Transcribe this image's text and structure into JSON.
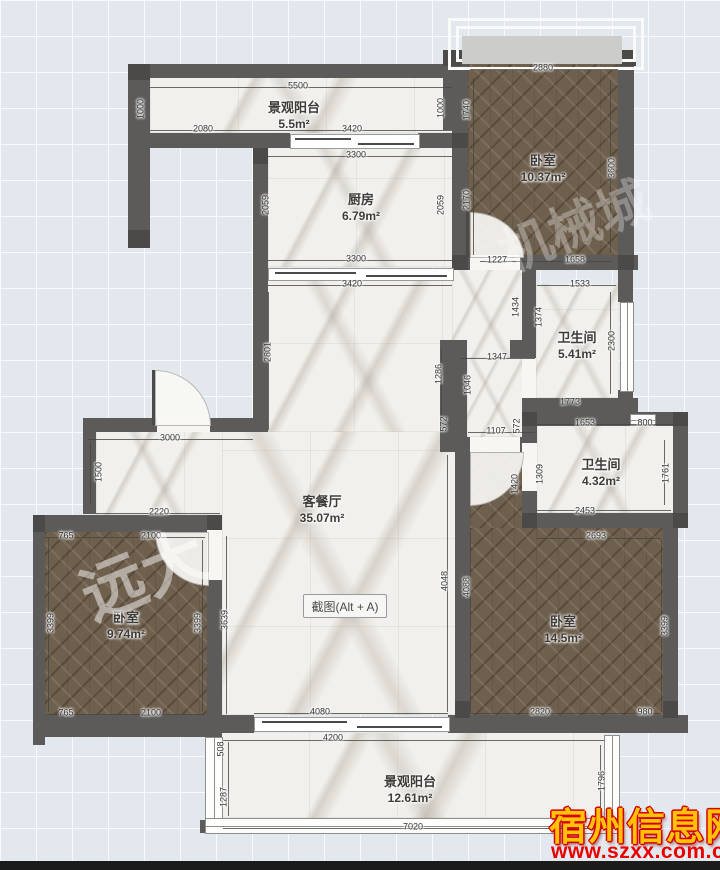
{
  "plan": {
    "type": "apartment-floor-plan",
    "total_labeled_area_m2": 104.35
  },
  "rooms": [
    {
      "name": "景观阳台",
      "area": "5.5m²"
    },
    {
      "name": "厨房",
      "area": "6.79m²"
    },
    {
      "name": "卧室",
      "area": "10.37m²"
    },
    {
      "name": "卫生间",
      "area": "5.41m²"
    },
    {
      "name": "卫生间",
      "area": "4.32m²"
    },
    {
      "name": "客餐厅",
      "area": "35.07m²"
    },
    {
      "name": "卧室",
      "area": "9.74m²"
    },
    {
      "name": "卧室",
      "area": "14.5m²"
    },
    {
      "name": "景观阳台",
      "area": "12.61m²"
    }
  ],
  "dimensions": [
    {
      "t": "5500",
      "x": 298,
      "y": 86,
      "v": 0
    },
    {
      "t": "1000",
      "x": 141,
      "y": 109,
      "v": 1
    },
    {
      "t": "2080",
      "x": 203,
      "y": 129,
      "v": 0
    },
    {
      "t": "3420",
      "x": 352,
      "y": 129,
      "v": 0
    },
    {
      "t": "1000",
      "x": 441,
      "y": 108,
      "v": 1
    },
    {
      "t": "1740",
      "x": 467,
      "y": 110,
      "v": 1
    },
    {
      "t": "2880",
      "x": 543,
      "y": 68,
      "v": 0
    },
    {
      "t": "3300",
      "x": 356,
      "y": 155,
      "v": 0
    },
    {
      "t": "2059",
      "x": 266,
      "y": 205,
      "v": 1
    },
    {
      "t": "2059",
      "x": 441,
      "y": 205,
      "v": 1
    },
    {
      "t": "2170",
      "x": 467,
      "y": 200,
      "v": 1
    },
    {
      "t": "3600",
      "x": 612,
      "y": 168,
      "v": 1
    },
    {
      "t": "3300",
      "x": 356,
      "y": 259,
      "v": 0
    },
    {
      "t": "1227",
      "x": 497,
      "y": 260,
      "v": 0
    },
    {
      "t": "1658",
      "x": 575,
      "y": 260,
      "v": 0
    },
    {
      "t": "3420",
      "x": 352,
      "y": 284,
      "v": 0
    },
    {
      "t": "2801",
      "x": 268,
      "y": 352,
      "v": 1
    },
    {
      "t": "1533",
      "x": 580,
      "y": 284,
      "v": 0
    },
    {
      "t": "1434",
      "x": 516,
      "y": 307,
      "v": 1
    },
    {
      "t": "1374",
      "x": 539,
      "y": 317,
      "v": 1
    },
    {
      "t": "2300",
      "x": 612,
      "y": 341,
      "v": 1
    },
    {
      "t": "1347",
      "x": 497,
      "y": 357,
      "v": 0
    },
    {
      "t": "1046",
      "x": 468,
      "y": 385,
      "v": 1
    },
    {
      "t": "1286",
      "x": 439,
      "y": 374,
      "v": 1
    },
    {
      "t": "572",
      "x": 444,
      "y": 424,
      "v": 1
    },
    {
      "t": "572",
      "x": 517,
      "y": 426,
      "v": 1
    },
    {
      "t": "1107",
      "x": 496,
      "y": 431,
      "v": 0
    },
    {
      "t": "1773",
      "x": 570,
      "y": 402,
      "v": 0
    },
    {
      "t": "1653",
      "x": 585,
      "y": 423,
      "v": 0
    },
    {
      "t": "800",
      "x": 645,
      "y": 423,
      "v": 0
    },
    {
      "t": "1420",
      "x": 515,
      "y": 484,
      "v": 1
    },
    {
      "t": "1309",
      "x": 540,
      "y": 474,
      "v": 1
    },
    {
      "t": "1761",
      "x": 666,
      "y": 473,
      "v": 1
    },
    {
      "t": "2453",
      "x": 585,
      "y": 511,
      "v": 0
    },
    {
      "t": "2693",
      "x": 596,
      "y": 536,
      "v": 0
    },
    {
      "t": "3000",
      "x": 170,
      "y": 438,
      "v": 0
    },
    {
      "t": "1500",
      "x": 99,
      "y": 472,
      "v": 1
    },
    {
      "t": "2220",
      "x": 159,
      "y": 512,
      "v": 0
    },
    {
      "t": "765",
      "x": 66,
      "y": 536,
      "v": 0
    },
    {
      "t": "2100",
      "x": 151,
      "y": 536,
      "v": 0
    },
    {
      "t": "3399",
      "x": 51,
      "y": 623,
      "v": 1
    },
    {
      "t": "3399",
      "x": 198,
      "y": 623,
      "v": 1
    },
    {
      "t": "3639",
      "x": 225,
      "y": 620,
      "v": 1
    },
    {
      "t": "765",
      "x": 66,
      "y": 713,
      "v": 0
    },
    {
      "t": "2100",
      "x": 151,
      "y": 713,
      "v": 0
    },
    {
      "t": "4048",
      "x": 445,
      "y": 581,
      "v": 1
    },
    {
      "t": "4088",
      "x": 467,
      "y": 587,
      "v": 1
    },
    {
      "t": "3399",
      "x": 665,
      "y": 626,
      "v": 1
    },
    {
      "t": "2820",
      "x": 540,
      "y": 712,
      "v": 0
    },
    {
      "t": "980",
      "x": 645,
      "y": 712,
      "v": 0
    },
    {
      "t": "4080",
      "x": 320,
      "y": 712,
      "v": 0
    },
    {
      "t": "4200",
      "x": 333,
      "y": 738,
      "v": 0
    },
    {
      "t": "508",
      "x": 221,
      "y": 749,
      "v": 1
    },
    {
      "t": "1287",
      "x": 224,
      "y": 797,
      "v": 1
    },
    {
      "t": "7020",
      "x": 413,
      "y": 827,
      "v": 0
    },
    {
      "t": "1796",
      "x": 602,
      "y": 781,
      "v": 1
    }
  ],
  "toolbar": {
    "screenshot_label": "截图(Alt + A)"
  },
  "watermarks": {
    "diagonal_1": "远大",
    "diagonal_2": "机械城",
    "site_name": "宿州信息网",
    "site_url": "www.szxx.com.cn"
  },
  "colors": {
    "wall": "#5c5b59",
    "wood_floor": "#6f604e",
    "marble_floor": "#f2f0ec",
    "background": "#e2e8ee",
    "brand_yellow": "#ffc10a",
    "brand_red": "#d40000"
  }
}
